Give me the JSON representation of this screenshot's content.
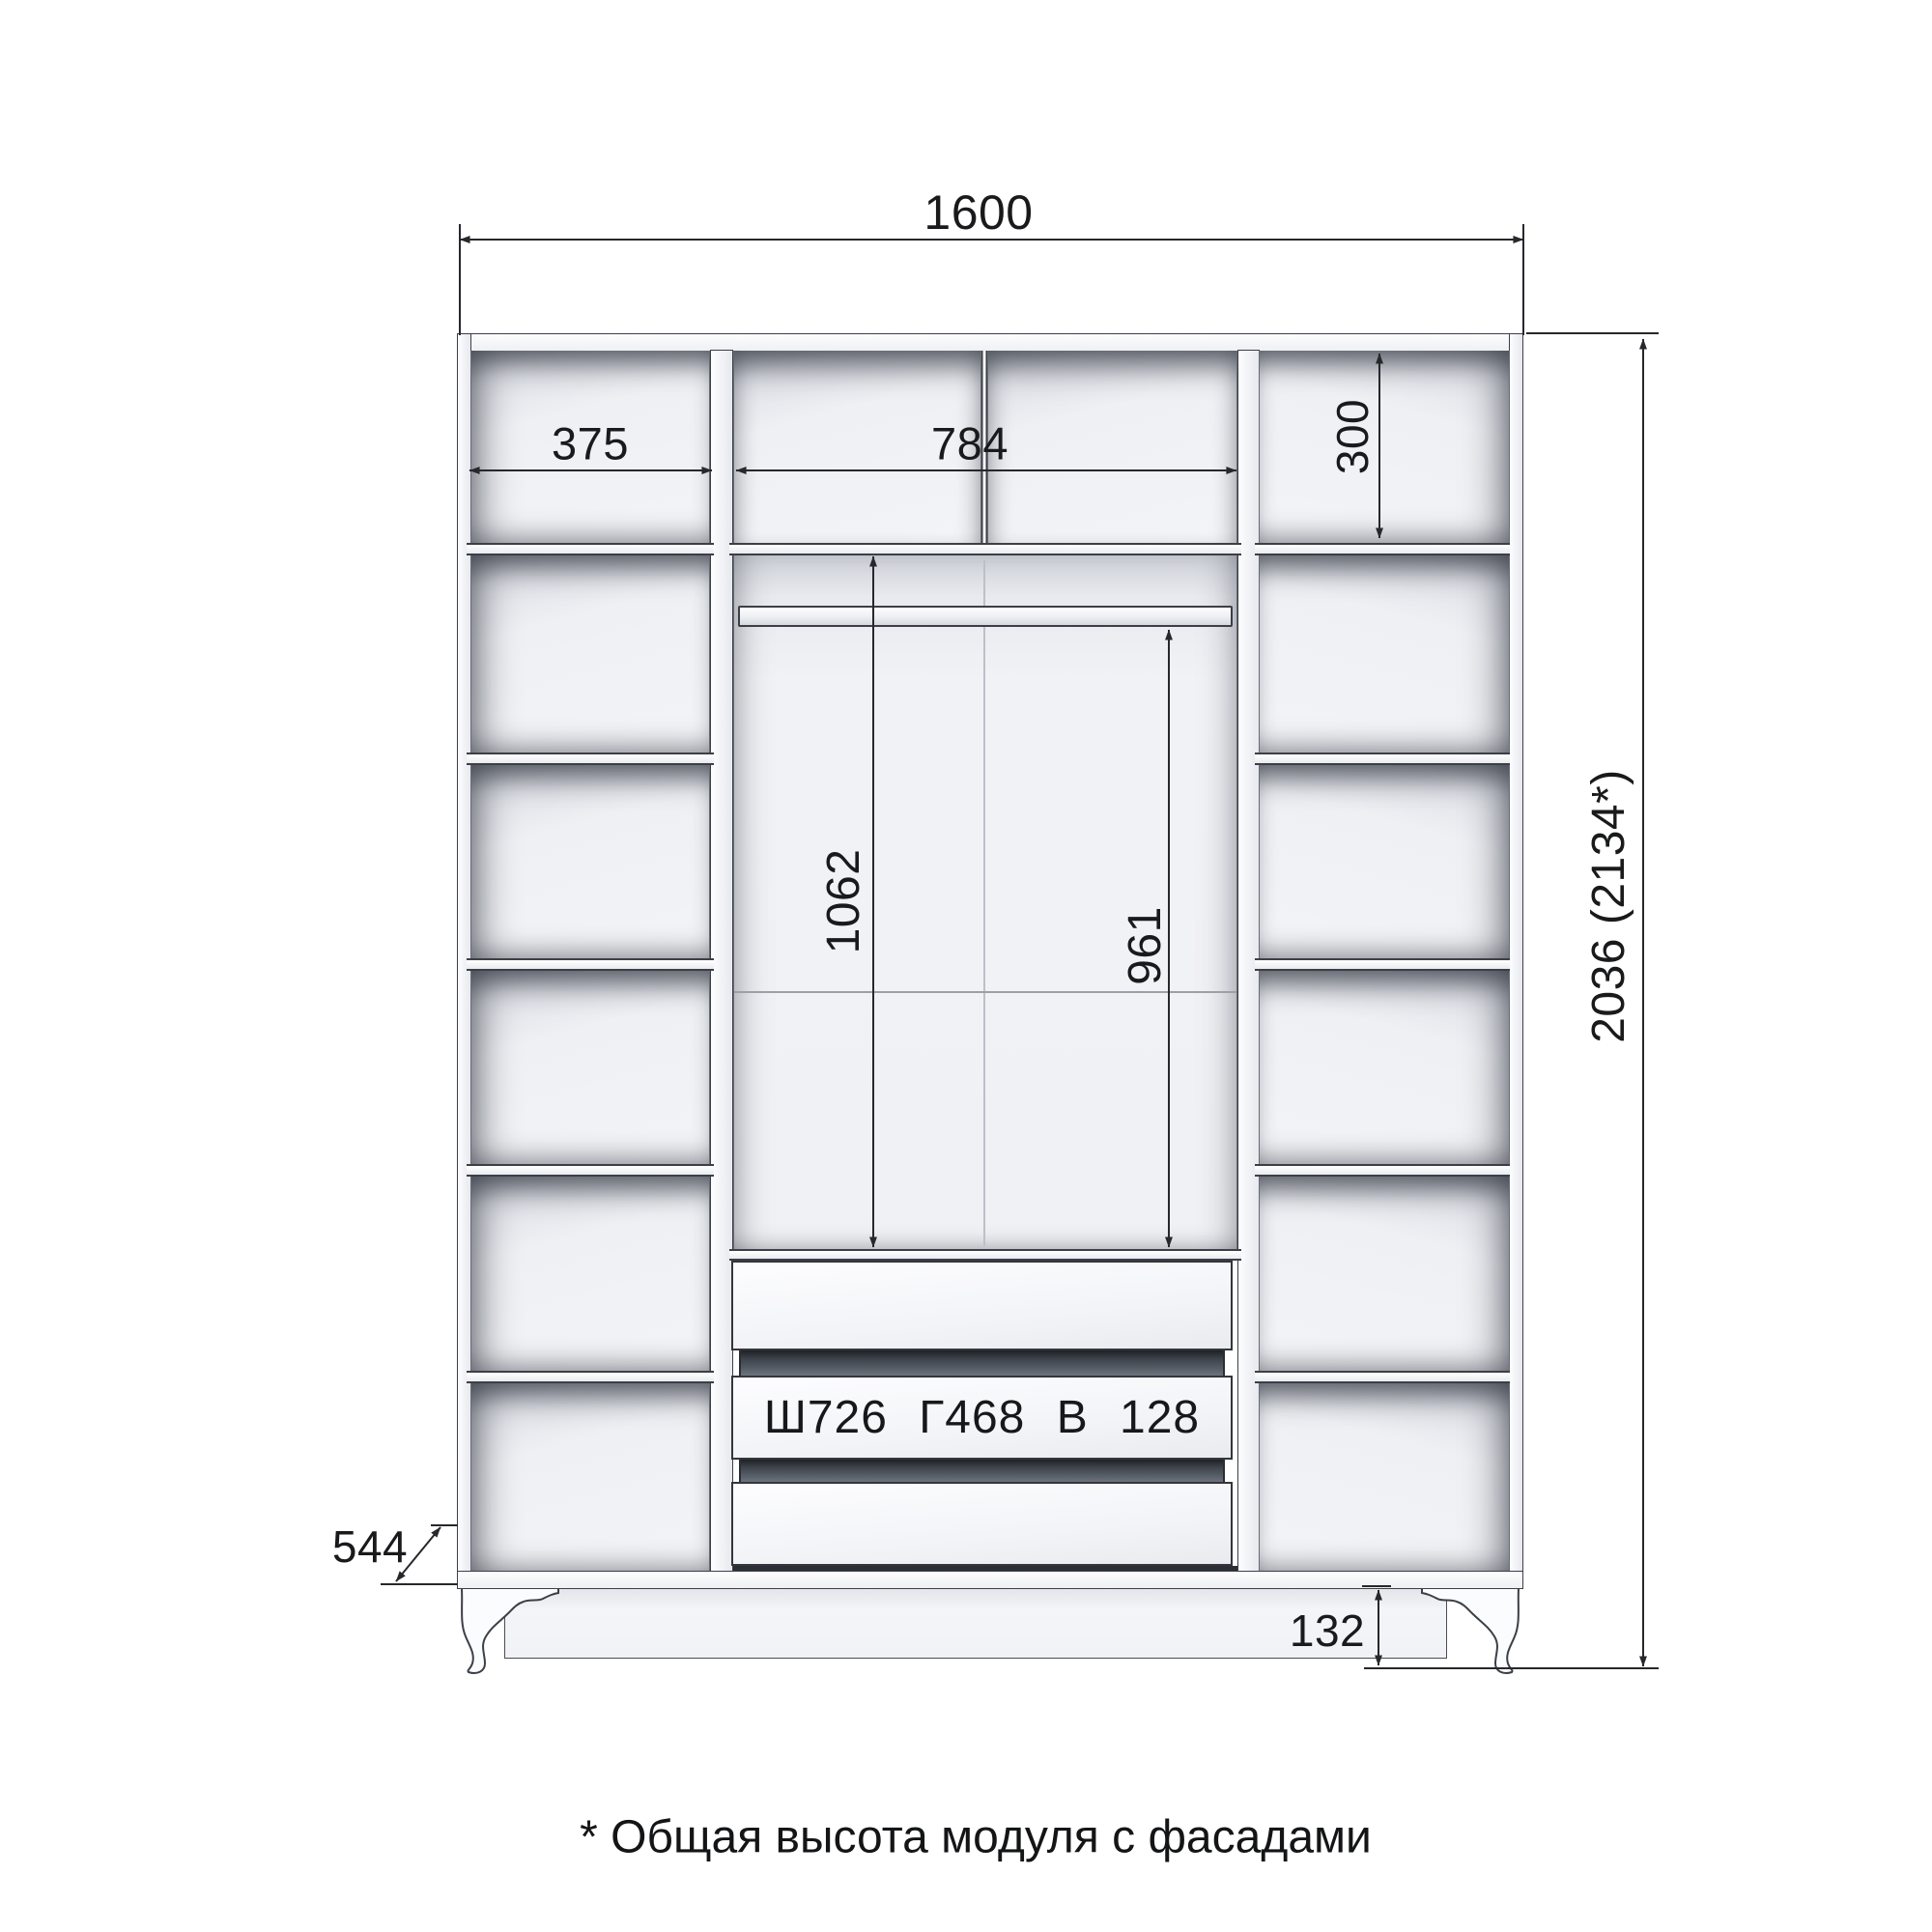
{
  "drawing": {
    "kind": "wardrobe technical drawing, front view with interior dimensions",
    "footnote": "* Общая высота модуля с фасадами",
    "drawer_label": "Ш726 Г468 В 128"
  },
  "dims": {
    "overall_width": "1600",
    "left_section_width": "375",
    "center_section_width": "784",
    "top_shelf_height": "300",
    "shelf_to_drawers_height": "1062",
    "rod_to_drawers_height": "961",
    "overall_height": "2036 (2134*)",
    "depth": "544",
    "plinth_height": "132"
  },
  "colors": {
    "background": "#ffffff",
    "outline": "#3c3f46",
    "dimension_line": "#26282c",
    "text": "#191a1c",
    "panel_white": "#f4f5f8",
    "interior_back": "#eef0f4",
    "interior_shadow": "#4a4e58",
    "drawer_gap_dark": "#2b2f35"
  },
  "structure": {
    "left_column_compartments": 6,
    "right_column_compartments": 6,
    "middle_drawers": 3,
    "has_hanging_rod": true
  }
}
